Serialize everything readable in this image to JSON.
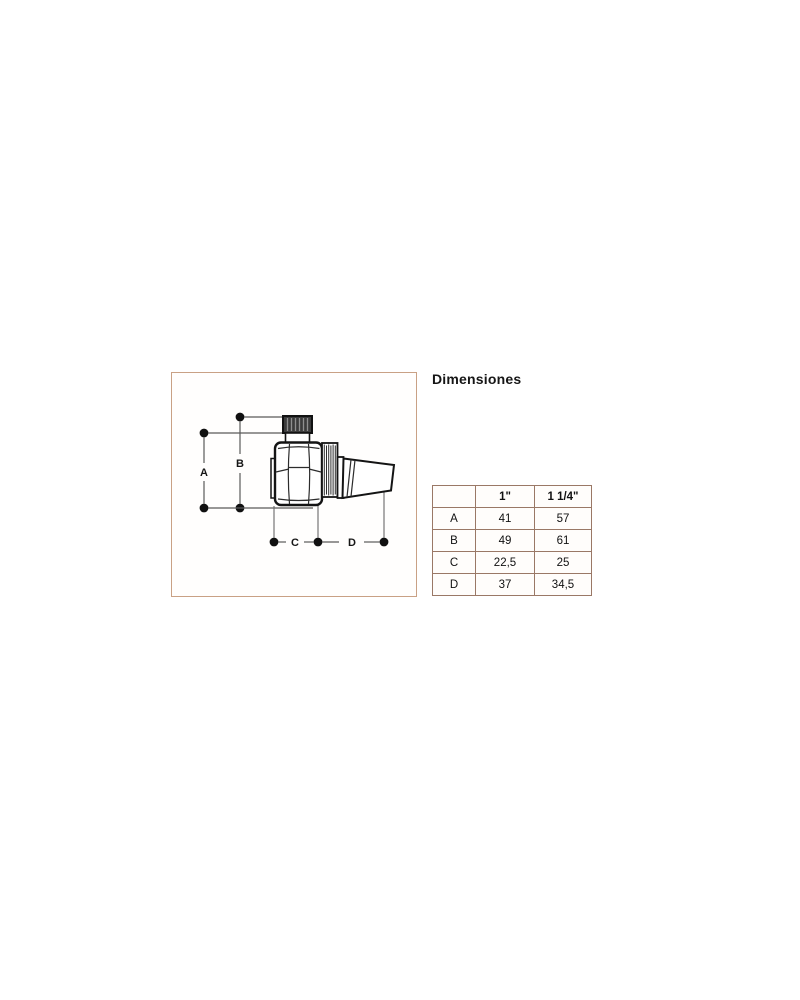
{
  "title": "Dimensiones",
  "colors": {
    "diagram_border": "#c9a185",
    "table_border": "#9a7866",
    "ink": "#1a1a1a",
    "dim_line": "#5a5a5a"
  },
  "diagram": {
    "description": "side-view line drawing of a radiator air-vent valve with dimension callouts",
    "dim_labels": {
      "a": "A",
      "b": "B",
      "c": "C",
      "d": "D"
    }
  },
  "table": {
    "header": [
      "",
      "1\"",
      "1 1/4\""
    ],
    "rows": [
      {
        "label": "A",
        "values": [
          "41",
          "57"
        ]
      },
      {
        "label": "B",
        "values": [
          "49",
          "61"
        ]
      },
      {
        "label": "C",
        "values": [
          "22,5",
          "25"
        ]
      },
      {
        "label": "D",
        "values": [
          "37",
          "34,5"
        ]
      }
    ]
  }
}
